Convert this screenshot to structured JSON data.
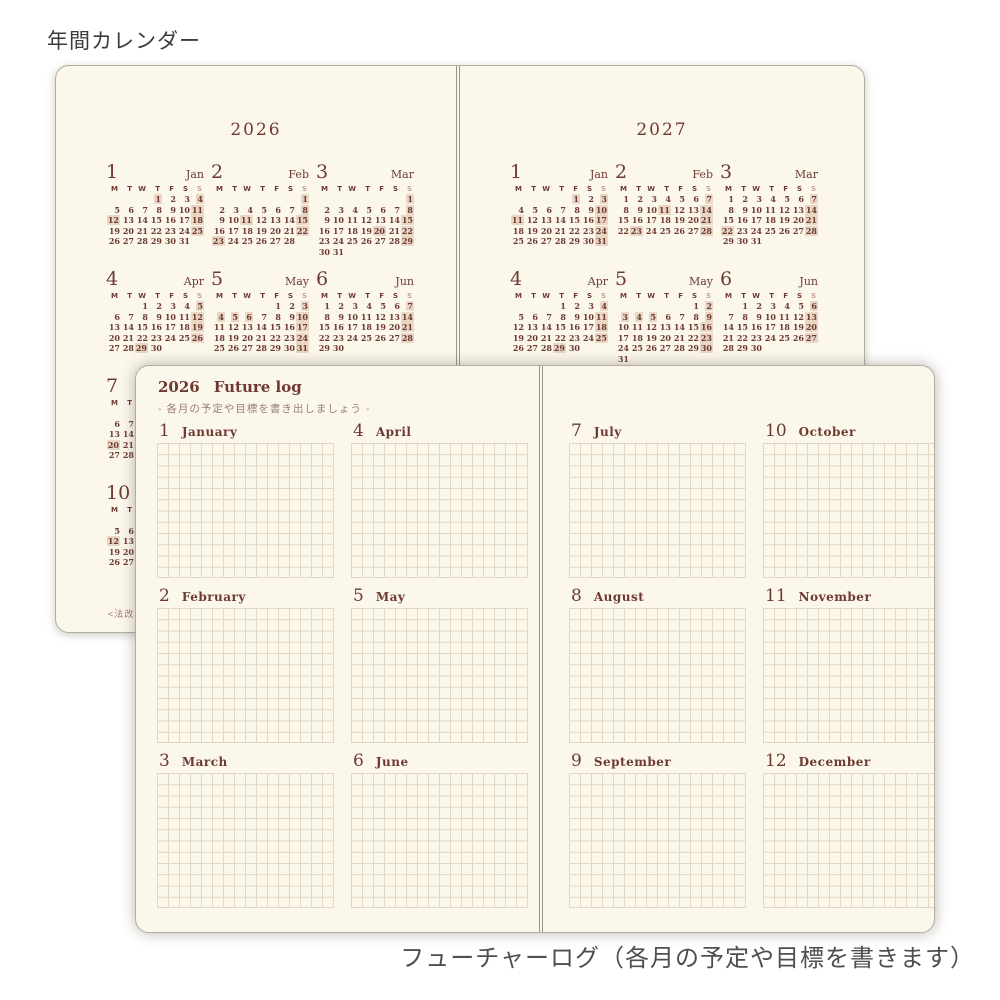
{
  "page_label": "年間カレンダー",
  "bottom_caption": "フューチャーログ（各月の予定や目標を書きます）",
  "colors": {
    "page_bg": "#fbf7eb",
    "ink": "#6e3a30",
    "sunday": "#c7a293",
    "highlight": "#e9d6c5",
    "grid_line": "#e2d7c0"
  },
  "calendar": {
    "weekday_header": [
      "M",
      "T",
      "W",
      "T",
      "F",
      "S",
      "S"
    ],
    "pages": [
      {
        "year": "2026",
        "footnote": "<法改正",
        "months": [
          {
            "num": "1",
            "name": "Jan",
            "highlights": [
              "1",
              "4",
              "11",
              "12",
              "18",
              "25"
            ],
            "weeks": [
              [
                "",
                "",
                "",
                "1",
                "2",
                "3",
                "4"
              ],
              [
                "5",
                "6",
                "7",
                "8",
                "9",
                "10",
                "11"
              ],
              [
                "12",
                "13",
                "14",
                "15",
                "16",
                "17",
                "18"
              ],
              [
                "19",
                "20",
                "21",
                "22",
                "23",
                "24",
                "25"
              ],
              [
                "26",
                "27",
                "28",
                "29",
                "30",
                "31",
                ""
              ]
            ]
          },
          {
            "num": "2",
            "name": "Feb",
            "highlights": [
              "1",
              "8",
              "11",
              "15",
              "22",
              "23"
            ],
            "weeks": [
              [
                "",
                "",
                "",
                "",
                "",
                "",
                "1"
              ],
              [
                "2",
                "3",
                "4",
                "5",
                "6",
                "7",
                "8"
              ],
              [
                "9",
                "10",
                "11",
                "12",
                "13",
                "14",
                "15"
              ],
              [
                "16",
                "17",
                "18",
                "19",
                "20",
                "21",
                "22"
              ],
              [
                "23",
                "24",
                "25",
                "26",
                "27",
                "28",
                ""
              ]
            ]
          },
          {
            "num": "3",
            "name": "Mar",
            "highlights": [
              "1",
              "8",
              "15",
              "20",
              "22",
              "29"
            ],
            "weeks": [
              [
                "",
                "",
                "",
                "",
                "",
                "",
                "1"
              ],
              [
                "2",
                "3",
                "4",
                "5",
                "6",
                "7",
                "8"
              ],
              [
                "9",
                "10",
                "11",
                "12",
                "13",
                "14",
                "15"
              ],
              [
                "16",
                "17",
                "18",
                "19",
                "20",
                "21",
                "22"
              ],
              [
                "23",
                "24",
                "25",
                "26",
                "27",
                "28",
                "29"
              ],
              [
                "30",
                "31",
                "",
                "",
                "",
                "",
                ""
              ]
            ]
          },
          {
            "num": "4",
            "name": "Apr",
            "highlights": [
              "5",
              "12",
              "19",
              "26",
              "29"
            ],
            "weeks": [
              [
                "",
                "",
                "1",
                "2",
                "3",
                "4",
                "5"
              ],
              [
                "6",
                "7",
                "8",
                "9",
                "10",
                "11",
                "12"
              ],
              [
                "13",
                "14",
                "15",
                "16",
                "17",
                "18",
                "19"
              ],
              [
                "20",
                "21",
                "22",
                "23",
                "24",
                "25",
                "26"
              ],
              [
                "27",
                "28",
                "29",
                "30",
                "",
                "",
                ""
              ]
            ]
          },
          {
            "num": "5",
            "name": "May",
            "highlights": [
              "3",
              "4",
              "5",
              "6",
              "10",
              "17",
              "24",
              "31"
            ],
            "weeks": [
              [
                "",
                "",
                "",
                "",
                "1",
                "2",
                "3"
              ],
              [
                "4",
                "5",
                "6",
                "7",
                "8",
                "9",
                "10"
              ],
              [
                "11",
                "12",
                "13",
                "14",
                "15",
                "16",
                "17"
              ],
              [
                "18",
                "19",
                "20",
                "21",
                "22",
                "23",
                "24"
              ],
              [
                "25",
                "26",
                "27",
                "28",
                "29",
                "30",
                "31"
              ]
            ]
          },
          {
            "num": "6",
            "name": "Jun",
            "highlights": [
              "7",
              "14",
              "21",
              "28"
            ],
            "weeks": [
              [
                "1",
                "2",
                "3",
                "4",
                "5",
                "6",
                "7"
              ],
              [
                "8",
                "9",
                "10",
                "11",
                "12",
                "13",
                "14"
              ],
              [
                "15",
                "16",
                "17",
                "18",
                "19",
                "20",
                "21"
              ],
              [
                "22",
                "23",
                "24",
                "25",
                "26",
                "27",
                "28"
              ],
              [
                "29",
                "30",
                "",
                "",
                "",
                "",
                ""
              ]
            ]
          },
          {
            "num": "7",
            "name": "Jul",
            "highlights": [
              "5",
              "12",
              "19",
              "20",
              "26"
            ],
            "weeks": [
              [
                "",
                "",
                "1",
                "2",
                "3",
                "4",
                "5"
              ],
              [
                "6",
                "7",
                "8",
                "9",
                "10",
                "11",
                "12"
              ],
              [
                "13",
                "14",
                "15",
                "16",
                "17",
                "18",
                "19"
              ],
              [
                "20",
                "21",
                "22",
                "23",
                "24",
                "25",
                "26"
              ],
              [
                "27",
                "28",
                "29",
                "30",
                "31",
                "",
                ""
              ]
            ]
          },
          {
            "num": "10",
            "name": "Oct",
            "highlights": [
              "4",
              "11",
              "12",
              "18",
              "25"
            ],
            "weeks": [
              [
                "",
                "",
                "",
                "1",
                "2",
                "3",
                "4"
              ],
              [
                "5",
                "6",
                "7",
                "8",
                "9",
                "10",
                "11"
              ],
              [
                "12",
                "13",
                "14",
                "15",
                "16",
                "17",
                "18"
              ],
              [
                "19",
                "20",
                "21",
                "22",
                "23",
                "24",
                "25"
              ],
              [
                "26",
                "27",
                "28",
                "29",
                "30",
                "31",
                ""
              ]
            ]
          }
        ]
      },
      {
        "year": "2027",
        "months": [
          {
            "num": "1",
            "name": "Jan",
            "highlights": [
              "1",
              "3",
              "10",
              "11",
              "17",
              "24",
              "31"
            ],
            "weeks": [
              [
                "",
                "",
                "",
                "",
                "1",
                "2",
                "3"
              ],
              [
                "4",
                "5",
                "6",
                "7",
                "8",
                "9",
                "10"
              ],
              [
                "11",
                "12",
                "13",
                "14",
                "15",
                "16",
                "17"
              ],
              [
                "18",
                "19",
                "20",
                "21",
                "22",
                "23",
                "24"
              ],
              [
                "25",
                "26",
                "27",
                "28",
                "29",
                "30",
                "31"
              ]
            ]
          },
          {
            "num": "2",
            "name": "Feb",
            "highlights": [
              "7",
              "11",
              "14",
              "21",
              "23",
              "28"
            ],
            "weeks": [
              [
                "1",
                "2",
                "3",
                "4",
                "5",
                "6",
                "7"
              ],
              [
                "8",
                "9",
                "10",
                "11",
                "12",
                "13",
                "14"
              ],
              [
                "15",
                "16",
                "17",
                "18",
                "19",
                "20",
                "21"
              ],
              [
                "22",
                "23",
                "24",
                "25",
                "26",
                "27",
                "28"
              ]
            ]
          },
          {
            "num": "3",
            "name": "Mar",
            "highlights": [
              "7",
              "14",
              "21",
              "22",
              "28"
            ],
            "weeks": [
              [
                "1",
                "2",
                "3",
                "4",
                "5",
                "6",
                "7"
              ],
              [
                "8",
                "9",
                "10",
                "11",
                "12",
                "13",
                "14"
              ],
              [
                "15",
                "16",
                "17",
                "18",
                "19",
                "20",
                "21"
              ],
              [
                "22",
                "23",
                "24",
                "25",
                "26",
                "27",
                "28"
              ],
              [
                "29",
                "30",
                "31",
                "",
                "",
                "",
                ""
              ]
            ]
          },
          {
            "num": "4",
            "name": "Apr",
            "highlights": [
              "4",
              "11",
              "18",
              "25",
              "29"
            ],
            "weeks": [
              [
                "",
                "",
                "",
                "1",
                "2",
                "3",
                "4"
              ],
              [
                "5",
                "6",
                "7",
                "8",
                "9",
                "10",
                "11"
              ],
              [
                "12",
                "13",
                "14",
                "15",
                "16",
                "17",
                "18"
              ],
              [
                "19",
                "20",
                "21",
                "22",
                "23",
                "24",
                "25"
              ],
              [
                "26",
                "27",
                "28",
                "29",
                "30",
                "",
                ""
              ]
            ]
          },
          {
            "num": "5",
            "name": "May",
            "highlights": [
              "2",
              "3",
              "4",
              "5",
              "9",
              "16",
              "23",
              "30"
            ],
            "weeks": [
              [
                "",
                "",
                "",
                "",
                "",
                "1",
                "2"
              ],
              [
                "3",
                "4",
                "5",
                "6",
                "7",
                "8",
                "9"
              ],
              [
                "10",
                "11",
                "12",
                "13",
                "14",
                "15",
                "16"
              ],
              [
                "17",
                "18",
                "19",
                "20",
                "21",
                "22",
                "23"
              ],
              [
                "24",
                "25",
                "26",
                "27",
                "28",
                "29",
                "30"
              ],
              [
                "31",
                "",
                "",
                "",
                "",
                "",
                ""
              ]
            ]
          },
          {
            "num": "6",
            "name": "Jun",
            "highlights": [
              "6",
              "13",
              "20",
              "27"
            ],
            "weeks": [
              [
                "",
                "1",
                "2",
                "3",
                "4",
                "5",
                "6"
              ],
              [
                "7",
                "8",
                "9",
                "10",
                "11",
                "12",
                "13"
              ],
              [
                "14",
                "15",
                "16",
                "17",
                "18",
                "19",
                "20"
              ],
              [
                "21",
                "22",
                "23",
                "24",
                "25",
                "26",
                "27"
              ],
              [
                "28",
                "29",
                "30",
                "",
                "",
                "",
                ""
              ]
            ]
          }
        ]
      }
    ]
  },
  "future_log": {
    "year": "2026",
    "title": "Future log",
    "subtitle": "- 各月の予定や目標を書き出しましょう -",
    "pages": [
      {
        "months": [
          {
            "num": "1",
            "name": "January"
          },
          {
            "num": "4",
            "name": "April"
          },
          {
            "num": "2",
            "name": "February"
          },
          {
            "num": "5",
            "name": "May"
          },
          {
            "num": "3",
            "name": "March"
          },
          {
            "num": "6",
            "name": "June"
          }
        ]
      },
      {
        "months": [
          {
            "num": "7",
            "name": "July"
          },
          {
            "num": "10",
            "name": "October"
          },
          {
            "num": "8",
            "name": "August"
          },
          {
            "num": "11",
            "name": "November"
          },
          {
            "num": "9",
            "name": "September"
          },
          {
            "num": "12",
            "name": "December"
          }
        ]
      }
    ]
  }
}
